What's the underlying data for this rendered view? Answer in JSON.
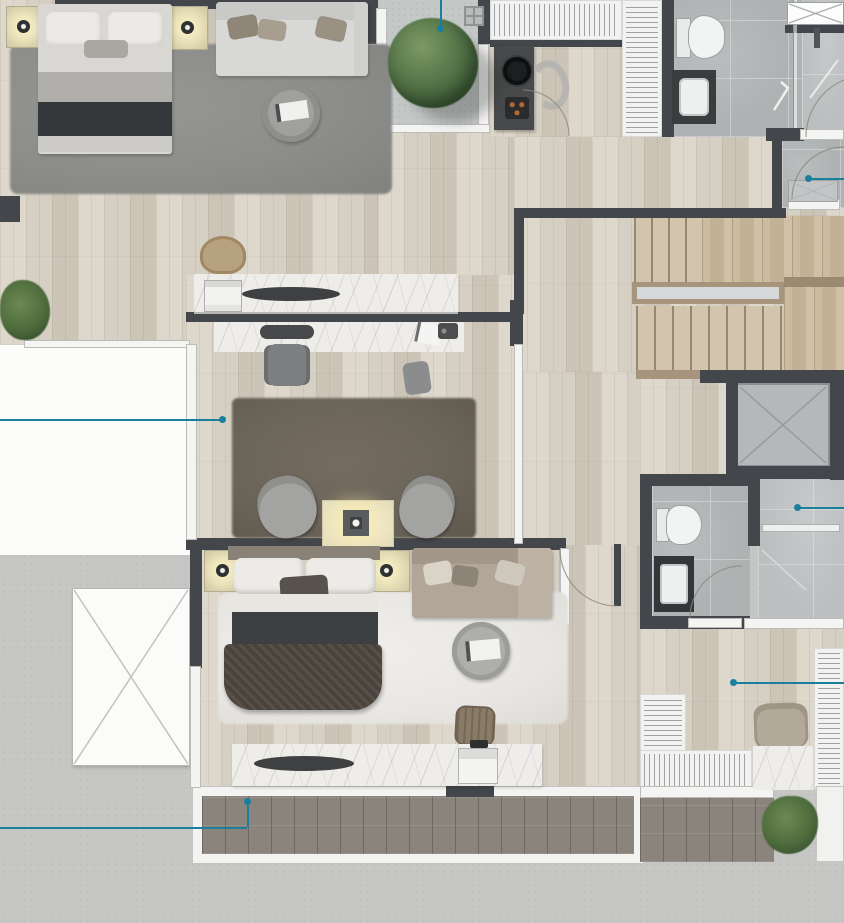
{
  "title": "Residential floor plan – rendered top view",
  "type": "architectural-floor-plan",
  "palette": {
    "wall": "#43464a",
    "wood": "#d6cfc3",
    "wood_dark": "#ccc4b6",
    "wood_light": "#ded7cb",
    "concrete": "#c6c6c4",
    "concrete_balcony": "#c4c8c7",
    "tile": "#afb2b3",
    "tile_light": "#bcbfc0",
    "white_floor": "#fcfcfb",
    "closet": "#f2f2f1",
    "marble": "#efedea",
    "deck": "#8a847c",
    "stair": "#d2c4ad",
    "landing": "#c8b89e",
    "rail": "#a6957c",
    "teal": "#1a7f9d",
    "rug_gray": "#8d8d8b",
    "rug_taupe": "#6b6459",
    "rug_white": "#e9e7e3",
    "tree_green": "#567549"
  },
  "rooms": [
    {
      "id": "bedroom-1",
      "furniture": [
        "double-bed",
        "nightstand-lamp",
        "nightstand-lamp",
        "shag-rug",
        "sofa",
        "round-coffee-table"
      ]
    },
    {
      "id": "planter-terrace",
      "furniture": [
        "tree",
        "floor-drain"
      ]
    },
    {
      "id": "walk-in-closet-1",
      "furniture": [
        "wardrobe-rack",
        "wardrobe-rack",
        "dressing-desk",
        "stool",
        "cup-tray",
        "lounge-chair"
      ]
    },
    {
      "id": "bathroom-1",
      "furniture": [
        "toilet",
        "washbasin",
        "walk-in-shower",
        "shower-glass",
        "wall-shelf"
      ]
    },
    {
      "id": "shower-room",
      "furniture": [
        "shower-tray",
        "door"
      ]
    },
    {
      "id": "hallway",
      "furniture": [
        "console-counter",
        "appliance",
        "serving-tray",
        "rattan-chair",
        "house-plant"
      ]
    },
    {
      "id": "bedroom-2",
      "furniture": [
        "vanity-counter",
        "desk-chair",
        "side-chair",
        "shag-rug",
        "swivel-armchair",
        "swivel-armchair",
        "lamp-table"
      ]
    },
    {
      "id": "staircase",
      "furniture": [
        "upper-flight",
        "wood-landing",
        "glass-railing",
        "lower-flight"
      ]
    },
    {
      "id": "elevator",
      "furniture": [
        "elevator-cab"
      ]
    },
    {
      "id": "bathroom-2",
      "furniture": [
        "toilet",
        "washbasin",
        "walk-in-shower",
        "shower-bar"
      ]
    },
    {
      "id": "bedroom-3",
      "furniture": [
        "double-bed",
        "nightstand-lamp",
        "nightstand-lamp",
        "shag-rug",
        "sofa",
        "round-coffee-table",
        "desk-chair",
        "vanity-counter",
        "laptop"
      ]
    },
    {
      "id": "balcony-bedroom-3",
      "furniture": [
        "wood-deck",
        "door-threshold"
      ]
    },
    {
      "id": "walk-in-closet-2",
      "furniture": [
        "wardrobe-rack",
        "wardrobe-rack",
        "armchair",
        "marble-floor"
      ]
    },
    {
      "id": "balcony-2",
      "furniture": [
        "wood-deck",
        "house-plant"
      ]
    },
    {
      "id": "roof-terrace",
      "furniture": [
        "skylight-hatch"
      ]
    }
  ],
  "callouts": {
    "color": "#1a7f9d",
    "items": [
      {
        "target": "planter-terrace",
        "dot": [
          440,
          28
        ],
        "segments": [
          [
            440,
            0,
            440,
            28
          ]
        ]
      },
      {
        "target": "shower-room",
        "dot": [
          808,
          178
        ],
        "segments": [
          [
            808,
            178,
            844,
            178
          ]
        ]
      },
      {
        "target": "bedroom-2",
        "dot": [
          222,
          419
        ],
        "segments": [
          [
            0,
            419,
            222,
            419
          ]
        ]
      },
      {
        "target": "bathroom-2-shower",
        "dot": [
          797,
          507
        ],
        "segments": [
          [
            797,
            507,
            844,
            507
          ]
        ]
      },
      {
        "target": "walk-in-closet-2",
        "dot": [
          733,
          682
        ],
        "segments": [
          [
            733,
            682,
            844,
            682
          ]
        ]
      },
      {
        "target": "balcony-bedroom-3",
        "dot": [
          247,
          801
        ],
        "segments": [
          [
            0,
            827,
            247,
            827
          ],
          [
            247,
            801,
            247,
            827
          ]
        ]
      }
    ]
  }
}
